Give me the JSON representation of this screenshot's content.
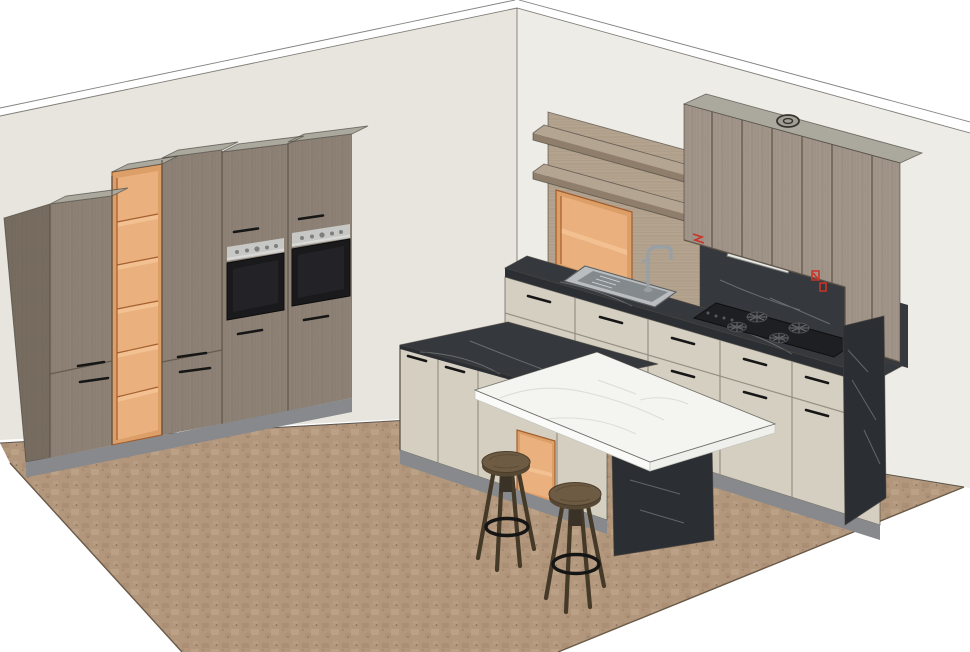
{
  "scene": {
    "type": "3d-kitchen-model",
    "render_style": "sketchup-like perspective render, open ceiling",
    "room": {
      "walls_visible": 2,
      "floor": "brown mottled tile",
      "outside": "white"
    },
    "tall_cabinet_wall": {
      "units": 5,
      "open_shelf_column_compartments": 6,
      "built_in_ovens": 2,
      "oven_control_strip": "stainless with knobs",
      "handle_style": "black bar",
      "plinth": "gray"
    },
    "right_wall_run": {
      "upper_doors": 6,
      "ceiling_vent_on_top": 1,
      "extractor_hood_strip": 1,
      "floating_wood_shelves": 2,
      "open_orange_wall_cube": 1,
      "wood_back_panel": 1,
      "sink": "stainless single bowl with drainer",
      "faucet": "chrome gooseneck",
      "gas_cooktop_burners": 4,
      "base_units": 5,
      "red_outlet_marks": 2,
      "countertop": "dark marble",
      "backsplash": "dark marble",
      "end_panel": "dark marble to floor"
    },
    "island": {
      "doors": 3,
      "open_orange_cube": 1,
      "countertop": "dark marble",
      "dining_table_top": "white marble",
      "table_support_panel": "dark marble",
      "plinth": "gray"
    },
    "bar_stools": {
      "count": 2,
      "seat": "round wood",
      "legs": 4,
      "footrest_ring": "black metal"
    }
  },
  "palette": {
    "wall_left": "#e8e5df",
    "wall_right": "#eeece7",
    "edge_line": "#43403a",
    "floor_base": "#b2977c",
    "floor_dark": "#9c8063",
    "floor_light": "#c6ae92",
    "floor_dot": "#604b38",
    "wood_front": "#8e8276",
    "wood_side": "#776c60",
    "wood_upper": "#a2958a",
    "wood_grain": "#5f5549",
    "wood_panel": "#b4a48f",
    "shelf_top": "#b4a492",
    "shelf_edge": "#8e7e6b",
    "carcass_top": "#aba89e",
    "orange_face": "#dd9f68",
    "orange_inner": "#eab07d",
    "orange_shelf": "#f2c091",
    "orange_line": "#9c5526",
    "steel": "#c7c7c5",
    "oven_glass": "#1a1a1d",
    "beige": "#d5cfc1",
    "plinth": "#87898c",
    "marble_dark": "#35383d",
    "marble_dark2": "#2b2e33",
    "vein_light": "#c9ccd0",
    "marble_white": "#f4f4f1",
    "vein_gray": "#d8d8d4",
    "stool_seat": "#6d5b44",
    "stool_leg": "#453928",
    "ring": "#151515",
    "steel_faucet": "#98a0a6",
    "hood": "#e9e9e6",
    "red_mark": "#cc3326"
  }
}
